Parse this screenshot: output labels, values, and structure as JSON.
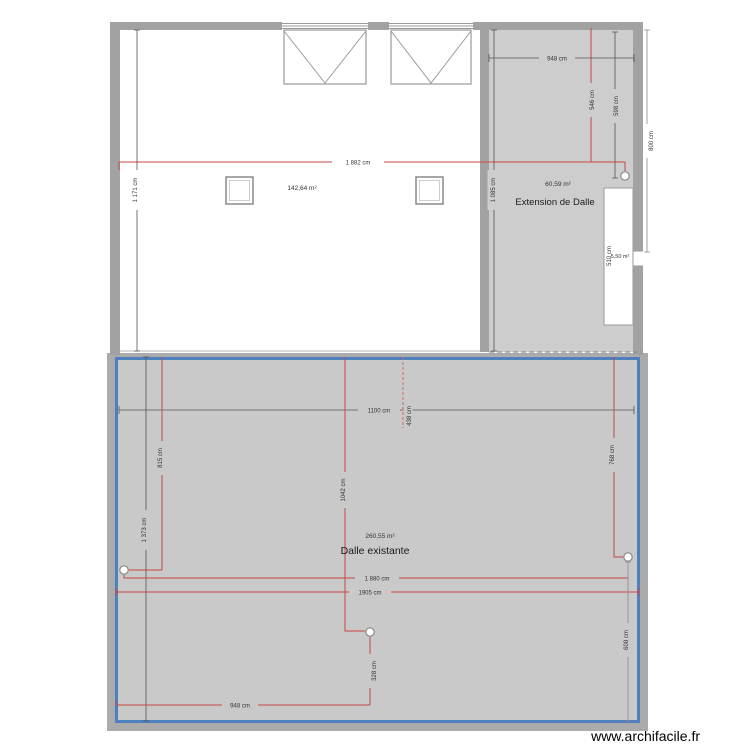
{
  "watermark": {
    "label": "www.archifacile.fr"
  },
  "colors": {
    "wall_gray": "#a2a2a2",
    "concrete_gray": "#cdcdcd",
    "slab_gray": "#c9c9c9",
    "slab_frame_gray": "#ababab",
    "slab_border_blue": "#4d80bd",
    "dimension_red": "#c84848",
    "dimension_black": "#555555"
  },
  "rooms": {
    "top_room": {
      "area": "142,64 m²"
    },
    "extension": {
      "area": "60,59 m²",
      "name": "Extension de Dalle"
    },
    "small_room": {
      "area": "5,50 m²"
    },
    "dalle": {
      "area": "260,55 m²",
      "name": "Dalle existante"
    }
  },
  "dimensions": {
    "top_width": "1 882 cm",
    "room_height": "1 171 cm",
    "extension_height": "1 085 cm",
    "extension_width": "948 cm",
    "ext_red_height": "546 cm",
    "ext_inner_height": "598 cm",
    "outer_right_height": "800 cm",
    "small_room_height": "510 cm",
    "dalle_top_width": "1100 cm",
    "dalle_top_offset": "438 cm",
    "dalle_left_red": "815 cm",
    "dalle_left_total": "1 373 cm",
    "dalle_mid_red": "1042 cm",
    "dalle_width_inner": "1 880 cm",
    "dalle_width_total": "1905 cm",
    "dalle_bottom_red": "948 cm",
    "dalle_mid_lower": "328 cm",
    "dalle_right_red": "768 cm",
    "dalle_right_lower": "608 cm"
  }
}
